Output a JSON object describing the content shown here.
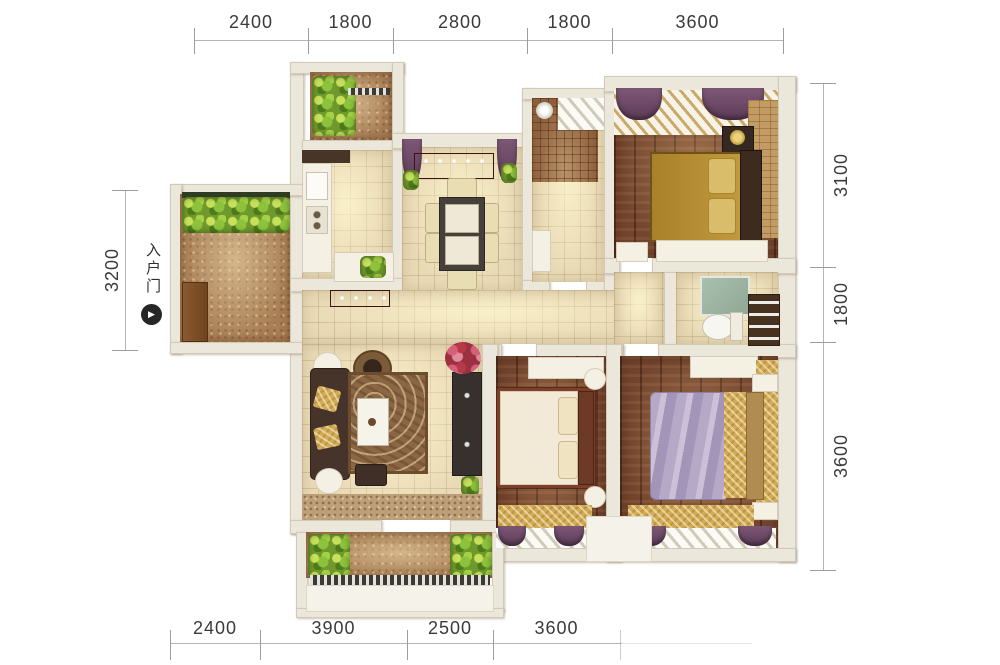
{
  "dimensions": {
    "top": [
      "2400",
      "1800",
      "2800",
      "1800",
      "3600"
    ],
    "bottom": [
      "2400",
      "3900",
      "2500",
      "3600"
    ],
    "left": [
      "3200"
    ],
    "right": [
      "3100",
      "1800",
      "3600"
    ]
  },
  "entrance": {
    "label": "入户门",
    "icon": "play-circle-icon",
    "arrow_glyph": "▶"
  },
  "colors": {
    "background": "#ffffff",
    "wall": "#ece7db",
    "tile_floor": "#e9dab6",
    "wood_floor": "#73452e",
    "balcony_tile": "#a97f55",
    "plant_green": "#8cc23c",
    "curtain_purple": "#6d4a66",
    "sideboard_maroon": "#5c211a",
    "gold_bedding": "#b18a2f",
    "lavender_bedding": "#b3a6c4",
    "dimension_text": "#3a3a3a",
    "dimension_line": "#b4b4b4"
  }
}
